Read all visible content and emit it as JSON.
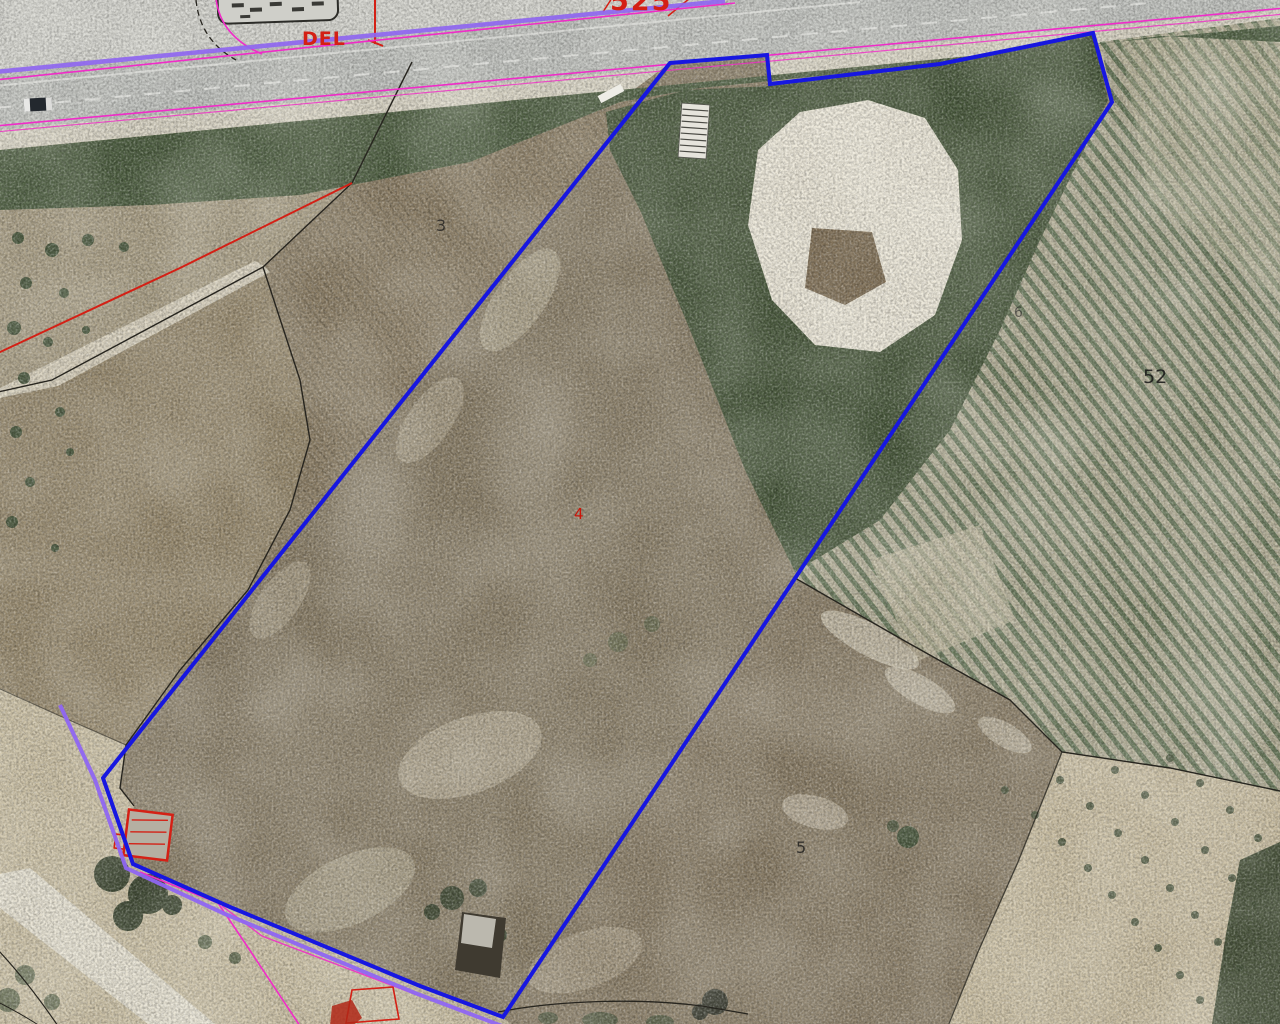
{
  "map": {
    "view": "aerial-cadastral-parcel-map",
    "labels": {
      "road_text": "DEL",
      "road_number": "525",
      "parcel_3": "3",
      "parcel_4": "4",
      "parcel_5": "5",
      "parcel_6": "6",
      "parcel_52": "52"
    },
    "colors": {
      "selected_parcel": "#1717e0",
      "road_axis_violet": "#8f66f2",
      "road_edge_magenta": "#f02cc8",
      "annotation_red": "#d42015",
      "parcel_boundary_black": "#27251f"
    }
  }
}
